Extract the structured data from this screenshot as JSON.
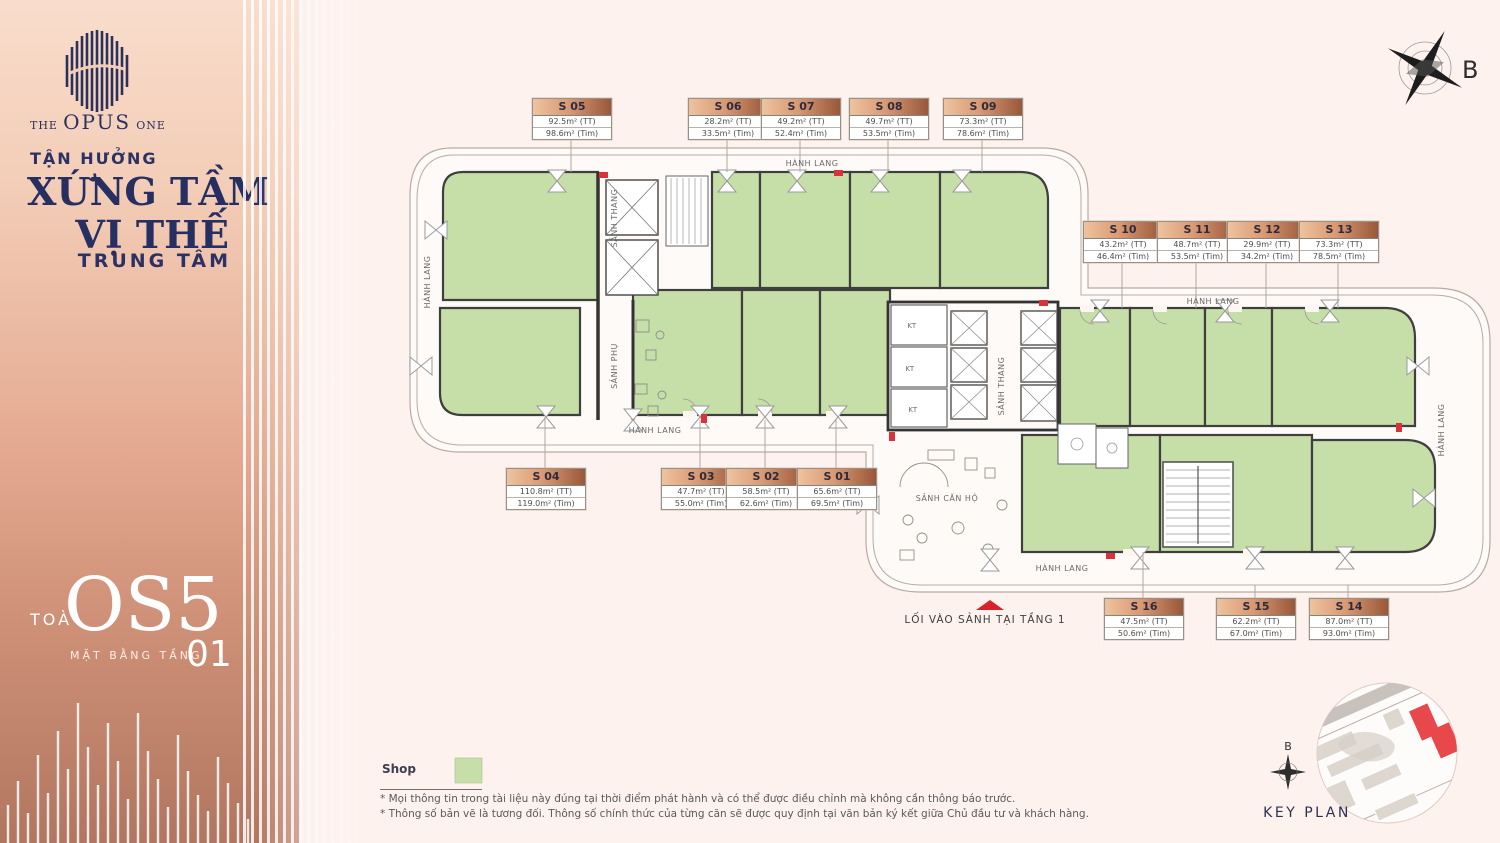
{
  "sidebar": {
    "brand": {
      "the": "THE",
      "opus": "OPUS",
      "one": "ONE"
    },
    "tagline1": "TẬN HƯỞNG",
    "tagline2": "XỨNG TẦM",
    "tagline3": "VỊ THẾ",
    "tagline4": "TRUNG TÂM",
    "tower_prefix": "TOÀ",
    "tower_name": "OS5",
    "floor_label": "MẶT BẰNG TẦNG",
    "floor_number": "01"
  },
  "compass": {
    "label": "B"
  },
  "plan": {
    "hanh_lang": "HÀNH LANG",
    "sanh_thang": "SẢNH THANG",
    "sanh_phu": "SẢNH PHỤ",
    "sanh_can_ho": "SẢNH CĂN HỘ",
    "kt": "KT"
  },
  "units": [
    {
      "id": "S 01",
      "tt": "65.6m² (TT)",
      "tim": "69.5m² (Tim)"
    },
    {
      "id": "S 02",
      "tt": "58.5m² (TT)",
      "tim": "62.6m² (Tim)"
    },
    {
      "id": "S 03",
      "tt": "47.7m² (TT)",
      "tim": "55.0m² (Tim)"
    },
    {
      "id": "S 04",
      "tt": "110.8m² (TT)",
      "tim": "119.0m² (Tim)"
    },
    {
      "id": "S 05",
      "tt": "92.5m² (TT)",
      "tim": "98.6m² (Tim)"
    },
    {
      "id": "S 06",
      "tt": "28.2m² (TT)",
      "tim": "33.5m² (Tim)"
    },
    {
      "id": "S 07",
      "tt": "49.2m² (TT)",
      "tim": "52.4m² (Tim)"
    },
    {
      "id": "S 08",
      "tt": "49.7m² (TT)",
      "tim": "53.5m² (Tim)"
    },
    {
      "id": "S 09",
      "tt": "73.3m² (TT)",
      "tim": "78.6m² (Tim)"
    },
    {
      "id": "S 10",
      "tt": "43.2m² (TT)",
      "tim": "46.4m² (Tim)"
    },
    {
      "id": "S 11",
      "tt": "48.7m² (TT)",
      "tim": "53.5m² (Tim)"
    },
    {
      "id": "S 12",
      "tt": "29.9m² (TT)",
      "tim": "34.2m² (Tim)"
    },
    {
      "id": "S 13",
      "tt": "73.3m² (TT)",
      "tim": "78.5m² (Tim)"
    },
    {
      "id": "S 14",
      "tt": "87.0m² (TT)",
      "tim": "93.0m² (Tim)"
    },
    {
      "id": "S 15",
      "tt": "62.2m² (TT)",
      "tim": "67.0m² (Tim)"
    },
    {
      "id": "S 16",
      "tt": "47.5m² (TT)",
      "tim": "50.6m² (Tim)"
    }
  ],
  "entrance": {
    "text": "LỐI VÀO SẢNH TẠI TẦNG 1"
  },
  "legend": {
    "shop_label": "Shop",
    "shop_color": "#c6dfa8"
  },
  "notes": [
    "* Mọi thông tin trong tài liệu này đúng tại thời điểm phát hành và có thể được điều chỉnh mà không cần thông báo trước.",
    "* Thông số bản vẽ là tương đối. Thông số chính thức của từng căn sẽ được quy định tại văn bản ký kết giữa Chủ đầu tư và khách hàng."
  ],
  "key_plan": {
    "title": "KEY PLAN",
    "compass": "B"
  }
}
